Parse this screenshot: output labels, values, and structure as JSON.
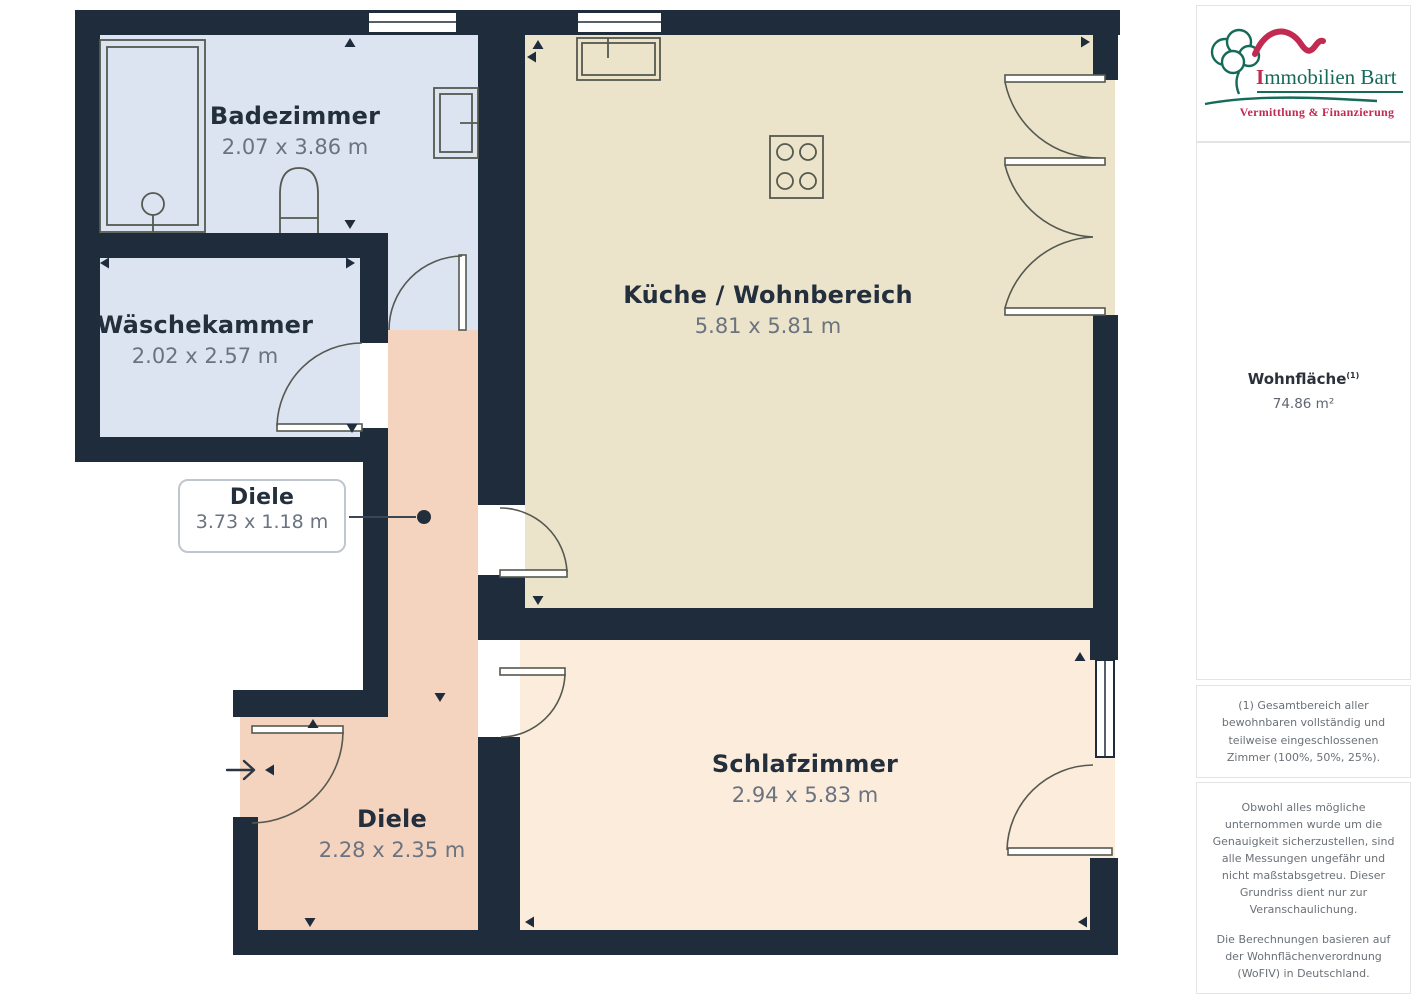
{
  "branding": {
    "logo_initial": "I",
    "logo_title_rest": "mmobilien Bart",
    "logo_subtitle": "Vermittlung & Finanzierung"
  },
  "sidebar": {
    "area_label": "Wohnfläche",
    "area_sup": "(1)",
    "area_value": "74.86 m²",
    "footnote": "(1) Gesamtbereich aller bewohnbaren vollständig und teilweise eingeschlossenen Zimmer (100%, 50%, 25%).",
    "disclaimer1": "Obwohl alles mögliche unternommen wurde um die Genauigkeit sicherzustellen, sind alle Messungen ungefähr und nicht maßstabsgetreu. Dieser Grundriss dient nur zur Veranschaulichung.",
    "disclaimer2": "Die Berechnungen basieren auf der Wohnflächenverordnung (WoFIV) in Deutschland.",
    "brand": "GIRAFFE",
    "brand_suffix": "360"
  },
  "rooms": [
    {
      "name": "Badezimmer",
      "dims": "2.07 x 3.86 m"
    },
    {
      "name": "Wäschekammer",
      "dims": "2.02 x 2.57 m"
    },
    {
      "name": "Küche / Wohnbereich",
      "dims": "5.81 x 5.81 m"
    },
    {
      "name": "Diele",
      "dims": "3.73 x 1.18 m"
    },
    {
      "name": "Diele",
      "dims": "2.28 x 2.35 m"
    },
    {
      "name": "Schlafzimmer",
      "dims": "2.94 x 5.83 m"
    }
  ],
  "colors": {
    "wall": "#1e2c3c",
    "bathroom_fill": "#dce3f1",
    "kitchen_fill": "#ece4ca",
    "hall_fill": "#f4d3bf",
    "bedroom_fill": "#fcecdc",
    "logo_green": "#156a58",
    "logo_red": "#c22a52"
  }
}
